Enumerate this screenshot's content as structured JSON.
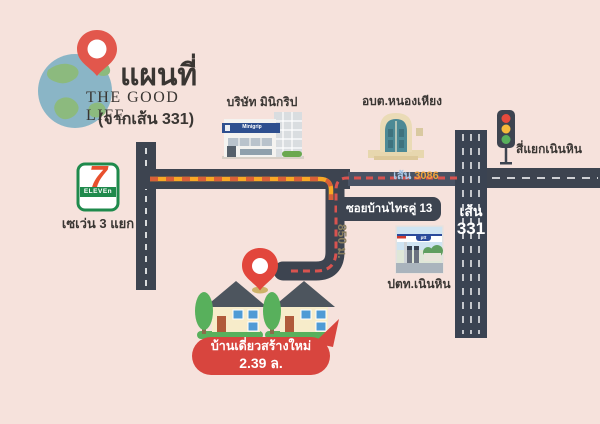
{
  "header": {
    "title_th": "แผนที่",
    "title_en": "THE GOOD LIFE",
    "subtitle": "(จากเส้น 331)"
  },
  "landmarks": {
    "company": {
      "label": "บริษัท มินิกริป",
      "sign": "Minigrip"
    },
    "sao": {
      "label": "อบต.หนองเหียง"
    },
    "seven": {
      "label": "เซเว่น 3 แยก",
      "logo_number": "7",
      "logo_text": "ELEVEn"
    },
    "ptt": {
      "label": "ปตท.เนินหิน",
      "logo": "ptt"
    },
    "intersection": {
      "label": "สี่แยกเนินหิน"
    }
  },
  "roads": {
    "route3086": {
      "prefix": "เส้น",
      "number": "3086"
    },
    "route331": {
      "prefix": "เส้น",
      "number": "331"
    },
    "soi": {
      "label": "ซอยบ้านไทรคู่ 13",
      "distance": "850 ม."
    }
  },
  "destination": {
    "line1": "บ้านเดี่ยวสร้างใหม่",
    "line2": "2.39 ล."
  },
  "colors": {
    "background": "#f6e2dc",
    "road": "#3d4450",
    "road_light": "#4a5364",
    "route_orange": "#f9a825",
    "route_red": "#d9534f",
    "bubble_red": "#d8453e",
    "pin_red": "#e2574c",
    "globe_water": "#8ab5c6",
    "globe_land": "#8cba7e",
    "seven_green": "#1f8a4c",
    "house_wall": "#f7ecca",
    "house_roof": "#4d555e",
    "tree_green": "#58b05c"
  }
}
